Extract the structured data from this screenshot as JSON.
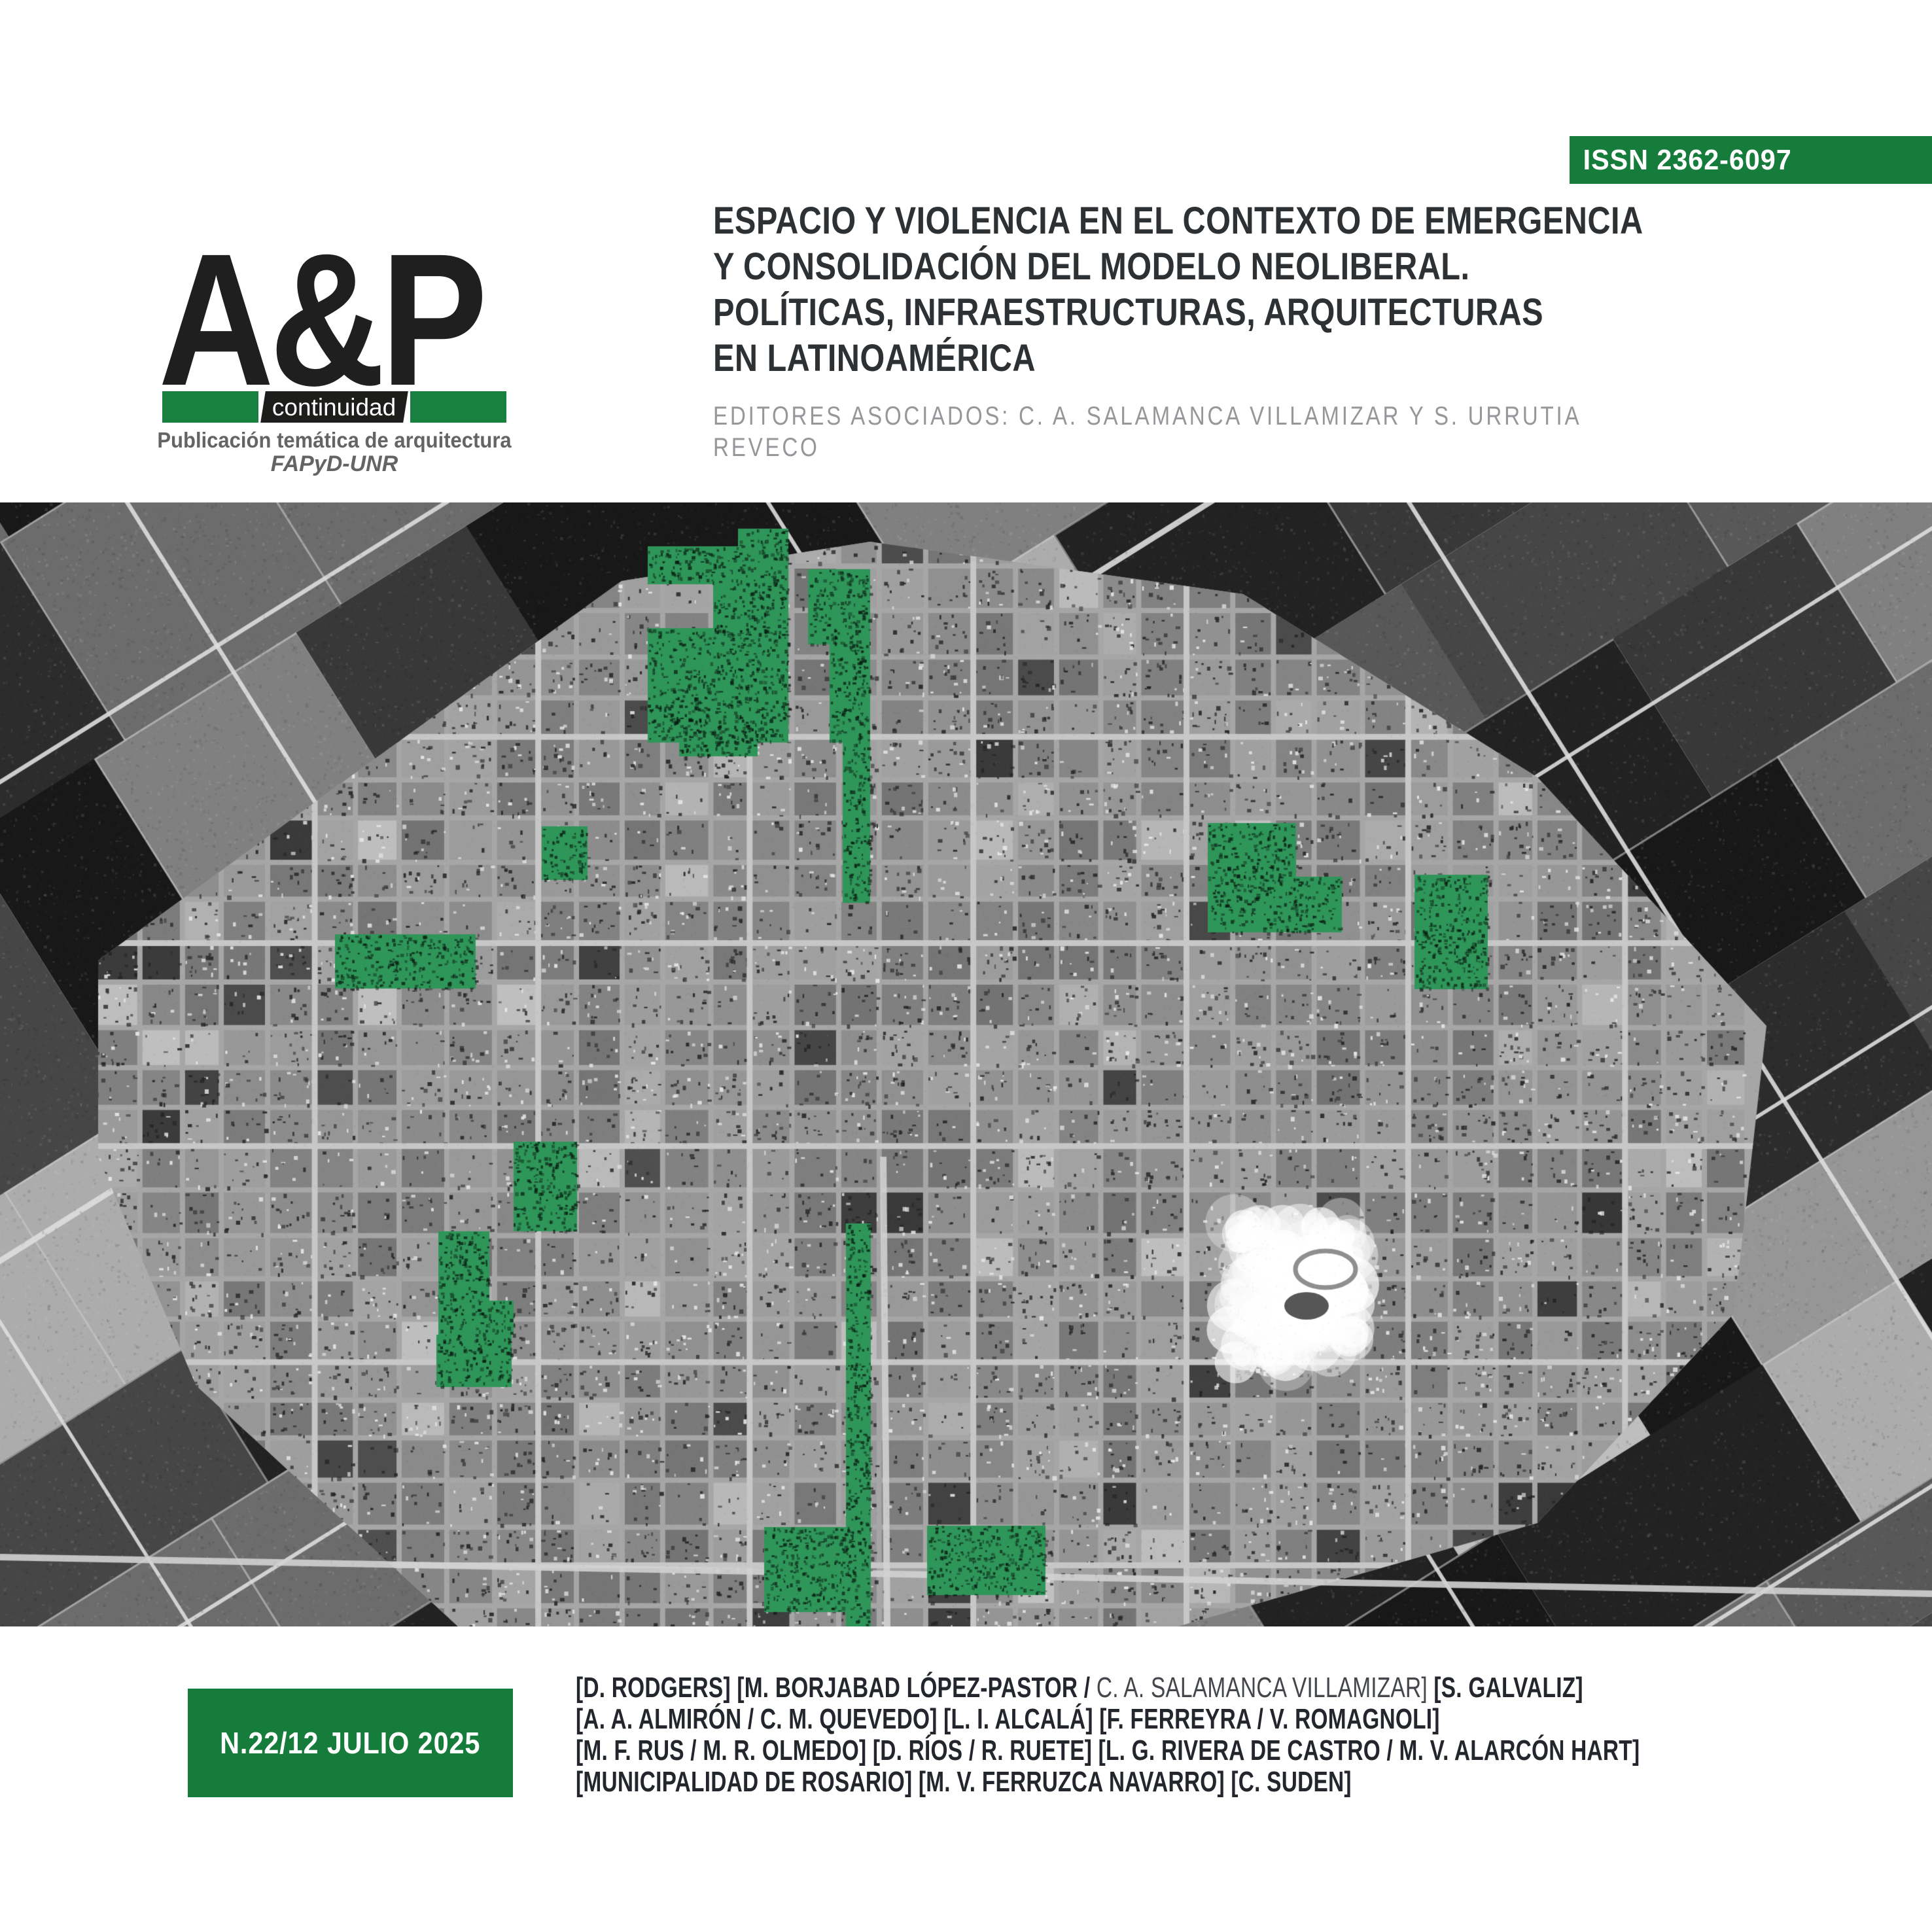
{
  "issn_banner": {
    "text": "ISSN 2362-6097",
    "bg": "#157C3B",
    "color": "#ffffff"
  },
  "logo": {
    "wordmark": "A&P",
    "bar_label": "continuidad",
    "bar_green": "#19813F",
    "bar_black": "#1d1d1b",
    "tagline1": "Publicación temática de arquitectura",
    "tagline2": "FAPyD-UNR"
  },
  "header": {
    "title_lines": [
      "ESPACIO Y VIOLENCIA EN EL CONTEXTO DE EMERGENCIA",
      "Y CONSOLIDACIÓN DEL MODELO NEOLIBERAL.",
      "POLÍTICAS, INFRAESTRUCTURAS, ARQUITECTURAS",
      "EN LATINOAMÉRICA"
    ],
    "editors_lines": [
      "EDITORES ASOCIADOS: C. A. SALAMANCA VILLAMIZAR Y S. URRUTIA",
      "REVECO"
    ]
  },
  "issue_box": {
    "text": "N.22/12 JULIO 2025",
    "bg": "#157C3B",
    "color": "#ffffff"
  },
  "authors": {
    "line1_prefix": "[D. RODGERS] [M. BORJABAD LÓPEZ-PASTOR / ",
    "line1_light": "C. A. SALAMANCA VILLAMIZAR]",
    "line1_suffix": " [S. GALVALIZ]",
    "line2": "[A. A. ALMIRÓN / C. M. QUEVEDO] [L. I. ALCALÁ] [F. FERREYRA / V. ROMAGNOLI]",
    "line3": "[M. F. RUS / M. R. OLMEDO] [D. RÍOS / R. RUETE] [L. G. RIVERA DE CASTRO / M. V. ALARCÓN HART]",
    "line4": "[MUNICIPALIDAD DE ROSARIO] [M. V. FERRUZCA NAVARRO] [C. SUDEN]"
  },
  "map": {
    "description": "Grayscale aerial photograph of a gridded town surrounded by farmland; selected urban blocks are highlighted in green.",
    "highlight_color": "#2F9659",
    "green_patches": [
      [
        990,
        67,
        215,
        58
      ],
      [
        1128,
        40,
        77,
        28
      ],
      [
        1090,
        122,
        115,
        85
      ],
      [
        990,
        192,
        215,
        175
      ],
      [
        1038,
        330,
        120,
        58
      ],
      [
        1235,
        102,
        95,
        115
      ],
      [
        1268,
        217,
        62,
        150
      ],
      [
        1288,
        367,
        42,
        245
      ],
      [
        1846,
        490,
        135,
        85
      ],
      [
        1846,
        572,
        205,
        85
      ],
      [
        2162,
        569,
        112,
        175
      ],
      [
        828,
        495,
        70,
        82
      ],
      [
        512,
        660,
        215,
        83
      ],
      [
        785,
        977,
        97,
        137
      ],
      [
        670,
        1114,
        78,
        158
      ],
      [
        745,
        1220,
        40,
        52
      ],
      [
        667,
        1272,
        115,
        80
      ],
      [
        1293,
        1102,
        38,
        616
      ],
      [
        1168,
        1566,
        130,
        130
      ],
      [
        1417,
        1564,
        181,
        106
      ]
    ]
  }
}
